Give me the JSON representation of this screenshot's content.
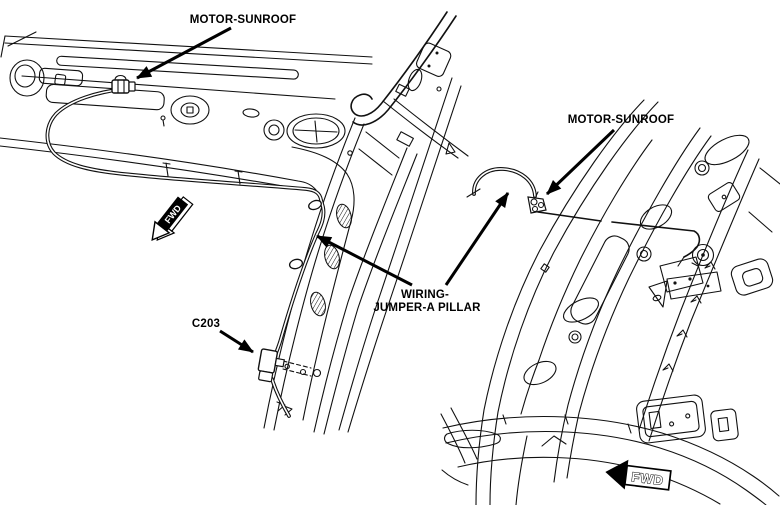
{
  "diagram": {
    "background_color": "#ffffff",
    "line_color": "#000000",
    "left_view": {
      "motor_label": "MOTOR-SUNROOF",
      "connector_label": "C203",
      "fwd_label": "FWD"
    },
    "jumper_label": {
      "line1": "WIRING-",
      "line2": "JUMPER-A PILLAR"
    },
    "right_view": {
      "motor_label": "MOTOR-SUNROOF",
      "fwd_label": "FWD"
    }
  }
}
